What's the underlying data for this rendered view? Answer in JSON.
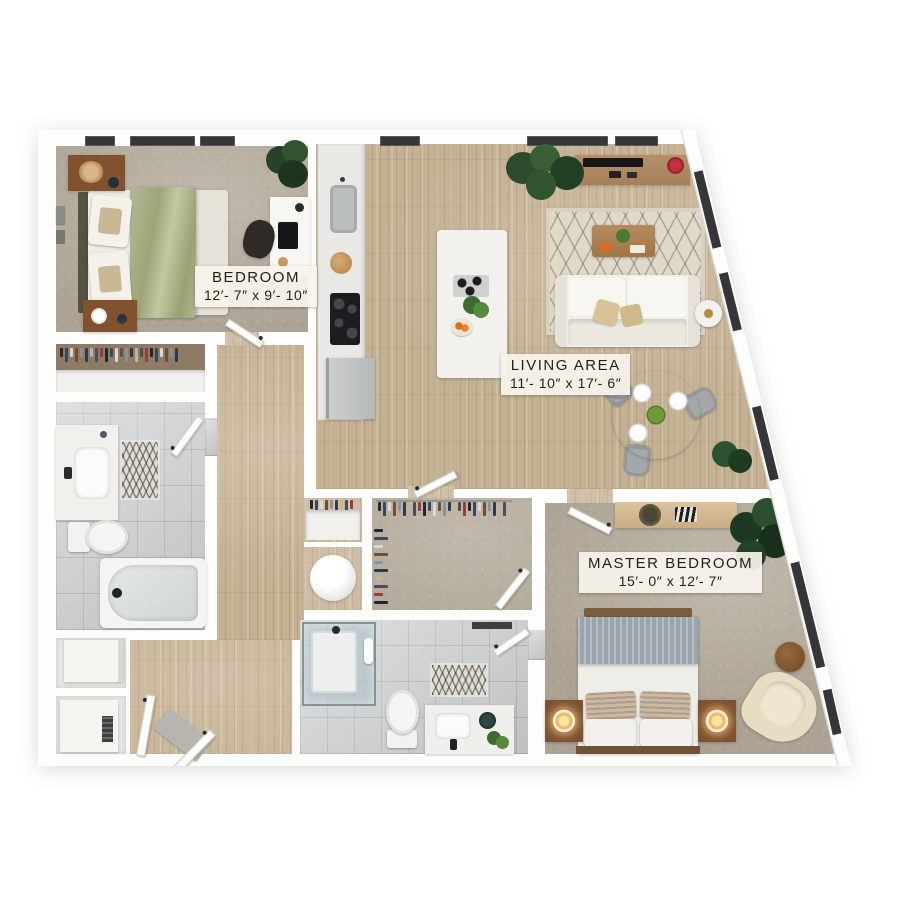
{
  "floorplan": {
    "rooms": [
      {
        "key": "bedroom",
        "name": "BEDROOM",
        "dims": "12′- 7″ x 9′- 10″"
      },
      {
        "key": "living-area",
        "name": "LIVING AREA",
        "dims": "11′- 10″ x 17′- 6″"
      },
      {
        "key": "master-bedroom",
        "name": "MASTER BEDROOM",
        "dims": "15′- 0″ x 12′- 7″"
      }
    ],
    "palette": {
      "wall": "#fdfdfb",
      "wood_floor": "#c4b093",
      "carpet": "#aca394",
      "tile": "#c9cccd",
      "window_frame": "#35363a",
      "duvet_green": "#a9af8d",
      "duvet_gray": "#9aa5ae",
      "plant_green": "#2c4a2e",
      "label_background": "#f7f4ec",
      "label_text": "#1f1f1f"
    },
    "closet_palette": [
      "#23262e",
      "#39465e",
      "#d7d9dc",
      "#714e31",
      "#8d9298",
      "#2d3a54",
      "#c4b494",
      "#4a4f57",
      "#9a3b35"
    ]
  }
}
